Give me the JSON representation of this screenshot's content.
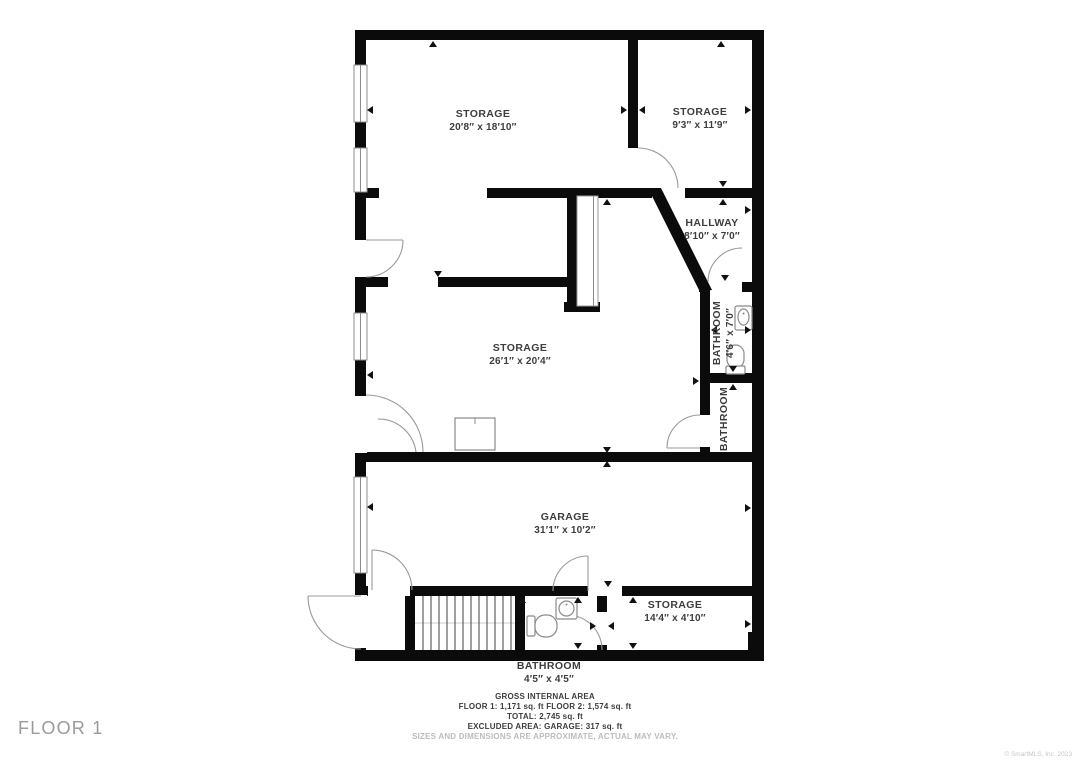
{
  "floor_label": "FLOOR 1",
  "copyright": "© SmartMLS, Inc. 2023",
  "rooms": [
    {
      "name": "STORAGE",
      "dims": "20′8″ x 18′10″",
      "x": 483,
      "y": 117,
      "rotate": 0
    },
    {
      "name": "STORAGE",
      "dims": "9′3″ x 11′9″",
      "x": 700,
      "y": 115,
      "rotate": 0
    },
    {
      "name": "HALLWAY",
      "dims": "8′10″ x 7′0″",
      "x": 712,
      "y": 226,
      "rotate": 0
    },
    {
      "name": "BATHROOM",
      "dims": "4′6″ x 7′0″",
      "x": 720,
      "y": 333,
      "rotate": -90
    },
    {
      "name": "STORAGE",
      "dims": "26′1″ x 20′4″",
      "x": 520,
      "y": 351,
      "rotate": 0
    },
    {
      "name": "BATHROOM",
      "dims": "",
      "x": 723,
      "y": 419,
      "rotate": -90
    },
    {
      "name": "GARAGE",
      "dims": "31′1″ x 10′2″",
      "x": 565,
      "y": 520,
      "rotate": 0
    },
    {
      "name": "STORAGE",
      "dims": "14′4″ x 4′10″",
      "x": 675,
      "y": 608,
      "rotate": 0
    },
    {
      "name": "BATHROOM",
      "dims": "4′5″ x 4′5″",
      "x": 549,
      "y": 669,
      "rotate": 0
    }
  ],
  "footer": {
    "line1": "GROSS INTERNAL AREA",
    "line2": "FLOOR 1: 1,171 sq. ft FLOOR 2: 1,574 sq. ft",
    "line3": "TOTAL: 2,745 sq. ft",
    "line4": "EXCLUDED AREA: GARAGE: 317 sq. ft",
    "disclaimer": "SIZES AND DIMENSIONS ARE APPROXIMATE, ACTUAL MAY VARY."
  },
  "colors": {
    "wall": "#0b0b0b",
    "text": "#3d3d3d",
    "line": "#9a9a9a",
    "muted": "#bcbcbc"
  }
}
